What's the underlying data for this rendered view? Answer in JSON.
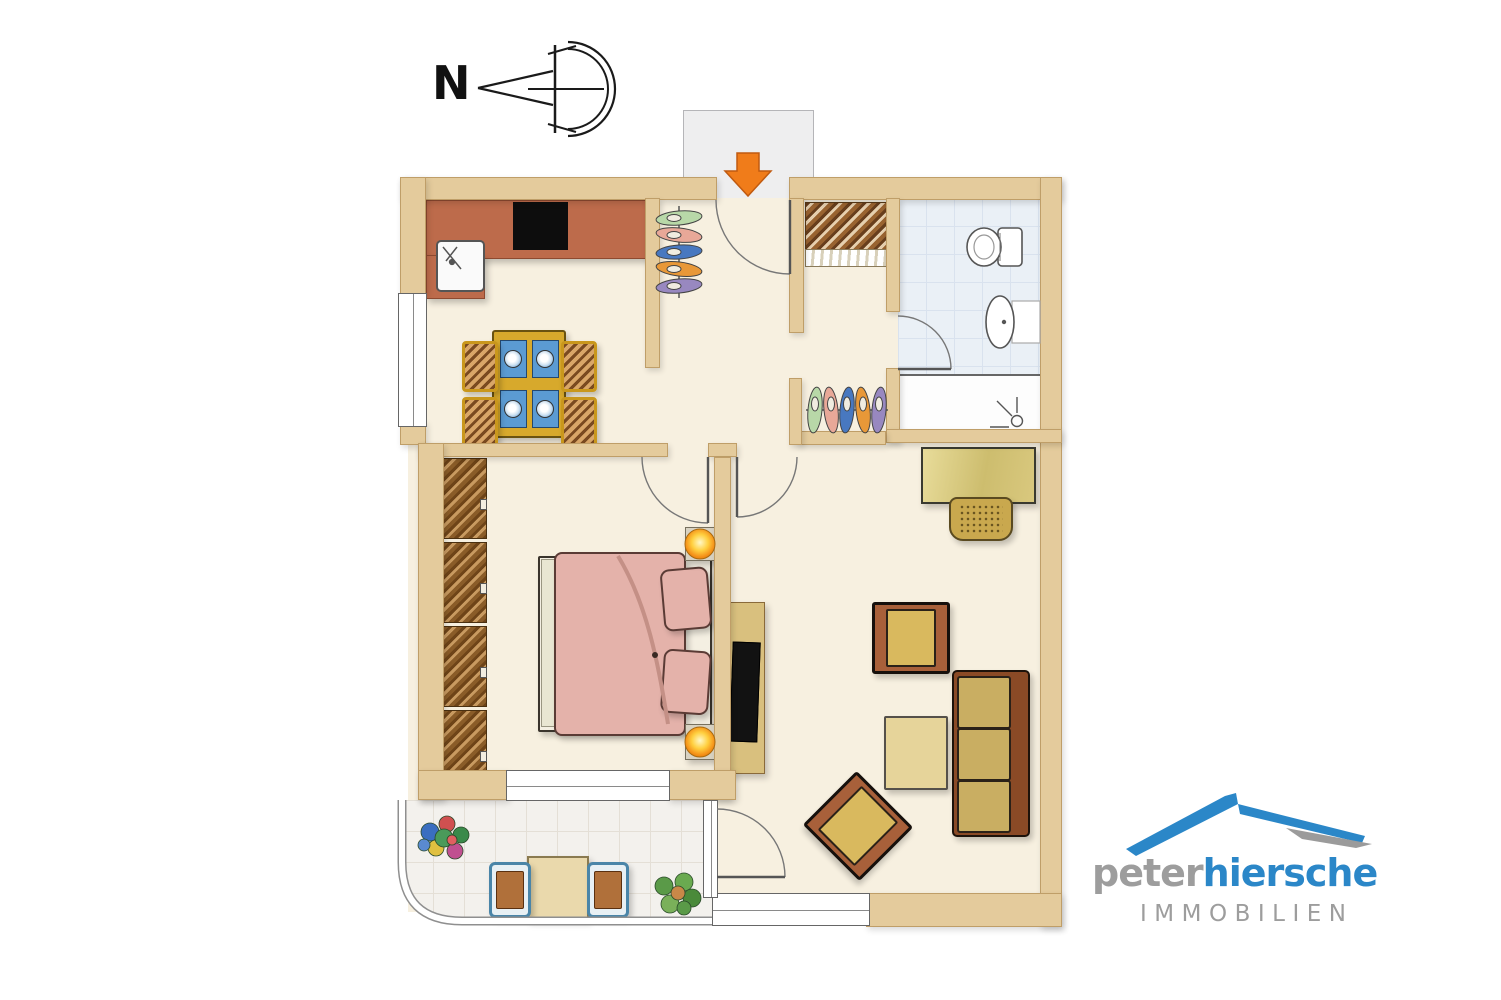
{
  "compass": {
    "label": "N"
  },
  "brand": {
    "word1": "peter",
    "word2": "hiersche",
    "subtitle": "IMMOBILIEN"
  },
  "palette": {
    "wall": "#e4cb9c",
    "walledge": "#bf9e68",
    "floor": "#f7f0e0",
    "counter": "#bd6b4b",
    "stove": "#0d0d0d",
    "arrow": "#f07c1a",
    "bathtile": "#eaf0f6",
    "balctile": "#f3f1ed",
    "bed": "#e4b2aa",
    "gold": "#d7a92c",
    "sofaframe": "#8a4a26",
    "cushion": "#c9ae62",
    "brandblue": "#2b87c8",
    "brandgray": "#9d9d9d"
  },
  "icons": {
    "north_arrow": "compass-north-arrow",
    "entrance_arrow": "entrance-direction-arrow"
  }
}
